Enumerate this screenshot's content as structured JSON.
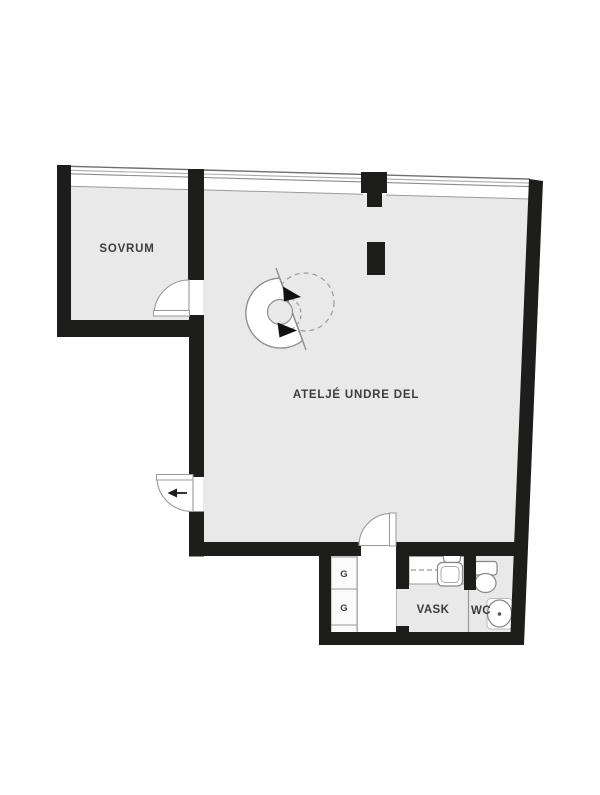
{
  "plan": {
    "type": "apartment-floorplan",
    "rooms": {
      "sovrum": {
        "label": "SOVRUM"
      },
      "atelje": {
        "label": "ATELJÉ UNDRE DEL"
      },
      "vask": {
        "label": "VASK"
      },
      "wc": {
        "label": "WC"
      },
      "closet_top": {
        "label": "G"
      },
      "closet_bottom": {
        "label": "G"
      }
    },
    "colors": {
      "wall": "#1d1d1b",
      "floor": "#e9e9e9",
      "outline": "#8f8f8f",
      "light_outline": "#b5b5b5",
      "label": "#3c3c3b",
      "fixture_fill": "#ffffff",
      "background": "#ffffff"
    }
  }
}
